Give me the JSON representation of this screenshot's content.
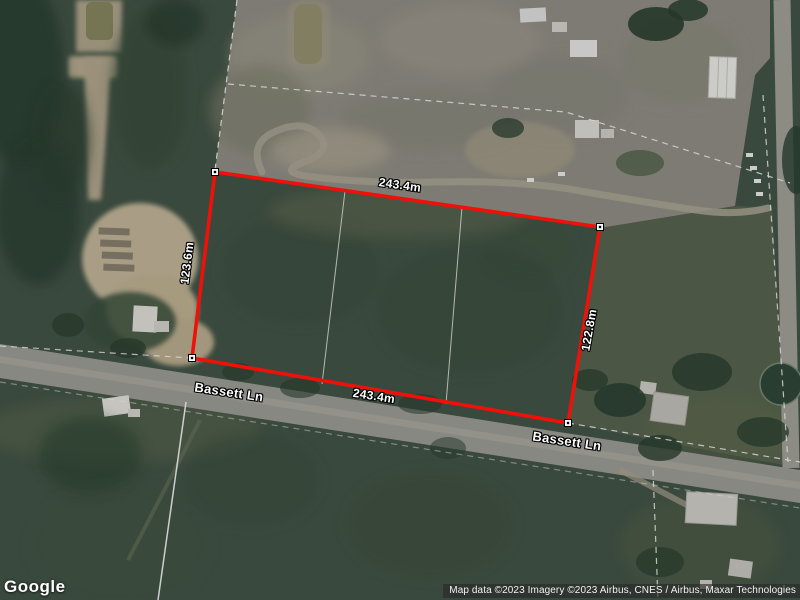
{
  "map": {
    "watermark": "Google",
    "attribution": "Map data ©2023 Imagery ©2023 Airbus, CNES / Airbus, Maxar Technologies"
  },
  "parcel": {
    "boundary_color": "#ee1109",
    "measurements": {
      "top": "243.4m",
      "bottom": "243.4m",
      "left": "123.6m",
      "right": "122.8m"
    }
  },
  "roads": {
    "labels": [
      "Bassett Ln",
      "Bassett Ln"
    ]
  }
}
